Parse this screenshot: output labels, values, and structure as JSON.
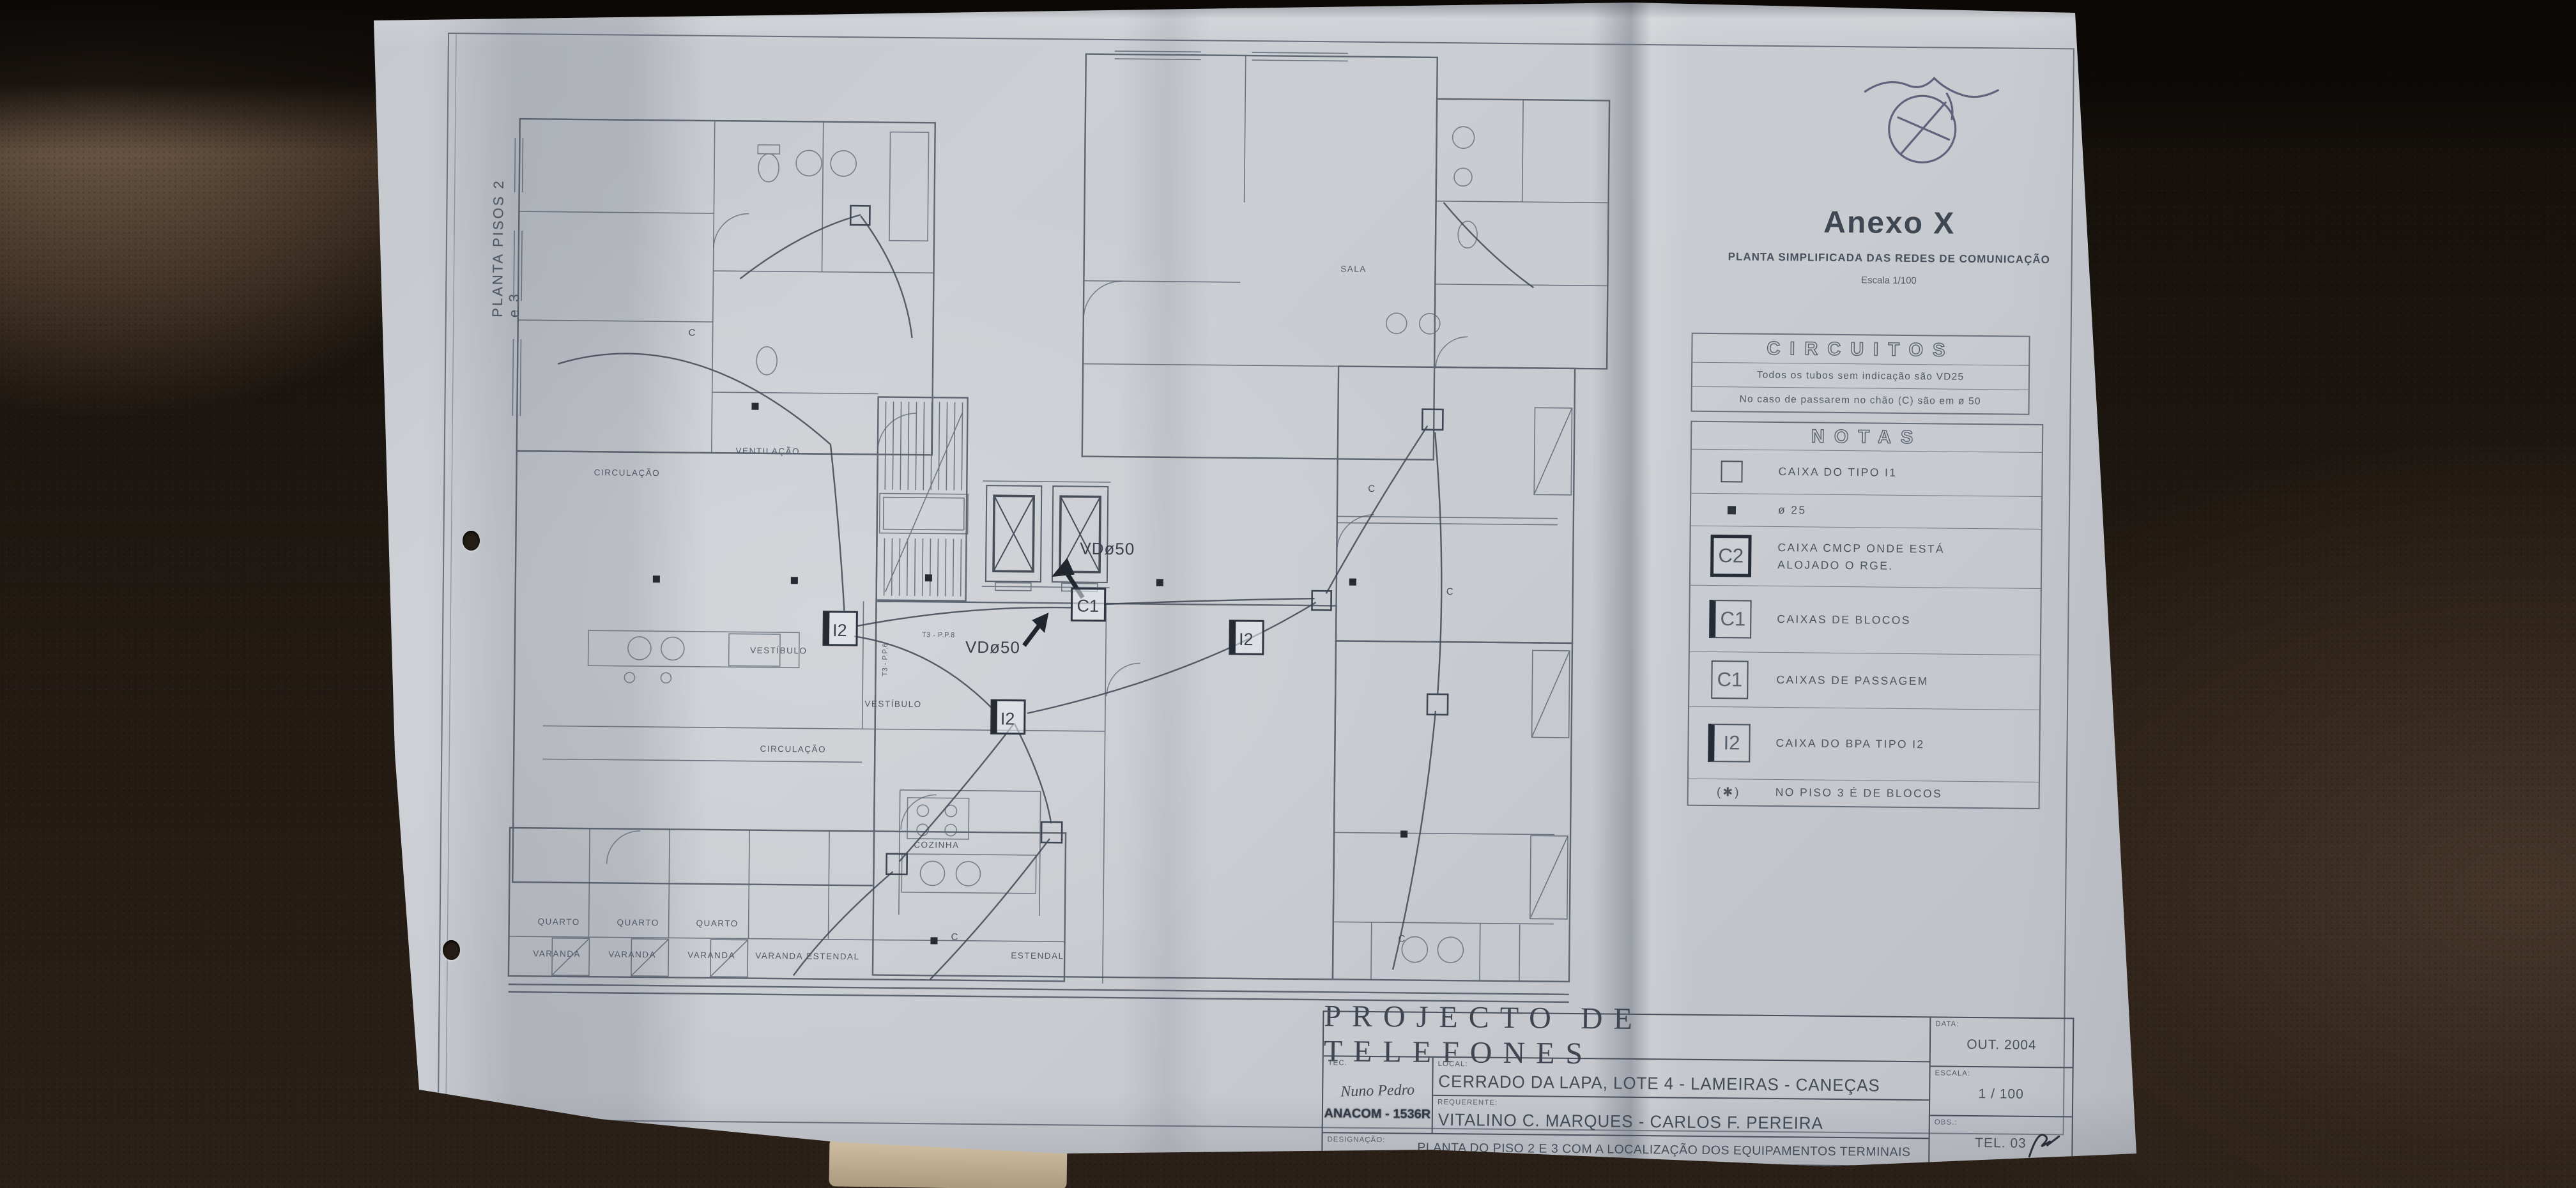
{
  "colors": {
    "paper": "#c9ccd1",
    "ink": "#4a525e",
    "leather": "#2a2018",
    "stamp_ink": "#4c4768"
  },
  "annex": {
    "title": "Anexo X",
    "subtitle": "PLANTA SIMPLIFICADA DAS REDES DE COMUNICAÇÃO",
    "scale": "Escala 1/100"
  },
  "circuitos": {
    "header": "CIRCUITOS",
    "line1": "Todos os tubos sem indicação são VD25",
    "line2": "No caso de passarem no chão (C) são em ø 50"
  },
  "notas": {
    "header": "NOTAS",
    "rows": [
      {
        "symbol": "square",
        "label": "CAIXA DO TIPO I1"
      },
      {
        "symbol": "dot",
        "label": "ø 25"
      },
      {
        "symbol": "C2",
        "label": "CAIXA CMCP ONDE ESTÁ ALOJADO O RGE."
      },
      {
        "symbol": "C1",
        "label": "CAIXAS DE BLOCOS"
      },
      {
        "symbol": "C1",
        "label": "CAIXAS DE PASSAGEM"
      },
      {
        "symbol": "I2",
        "label": "CAIXA DO BPA TIPO I2"
      },
      {
        "symbol": "(✱)",
        "label": "NO PISO 3 É DE BLOCOS"
      }
    ]
  },
  "title_block": {
    "title": "PROJECTO DE TELEFONES",
    "tec_label": "TEC.",
    "tec_name": "Nuno Pedro",
    "tec_org": "ANACOM - 1536R",
    "local_label": "LOCAL:",
    "local_value": "CERRADO DA LAPA, LOTE 4 - LAMEIRAS - CANEÇAS",
    "requerente_label": "REQUERENTE:",
    "requerente_value": "VITALINO C. MARQUES - CARLOS F. PEREIRA",
    "designacao_label": "DESIGNAÇÃO:",
    "designacao_value": "PLANTA DO PISO 2 E 3 COM A LOCALIZAÇÃO DOS EQUIPAMENTOS TERMINAIS",
    "data_label": "DATA:",
    "data_value": "OUT. 2004",
    "escala_label": "ESCALA:",
    "escala_value": "1 / 100",
    "obs_label": "OBS.:",
    "obs_value": "TEL. 03"
  },
  "plan": {
    "side_label": "PLANTA PISOS 2 e 3",
    "labels": {
      "vd50": "VDø50",
      "i2": "I2",
      "c1": "C1",
      "c": "C",
      "vestibulo": "VESTÍBULO",
      "circulacao": "CIRCULAÇÃO",
      "ventilacao": "VENTILAÇÃO",
      "cozinha": "COZINHA",
      "quarto": "QUARTO",
      "varanda": "VARANDA",
      "estendal": "ESTENDAL",
      "sala": "SALA",
      "t3a": "T3 - P.P.8",
      "t3b": "T3 - P.P.6"
    }
  }
}
